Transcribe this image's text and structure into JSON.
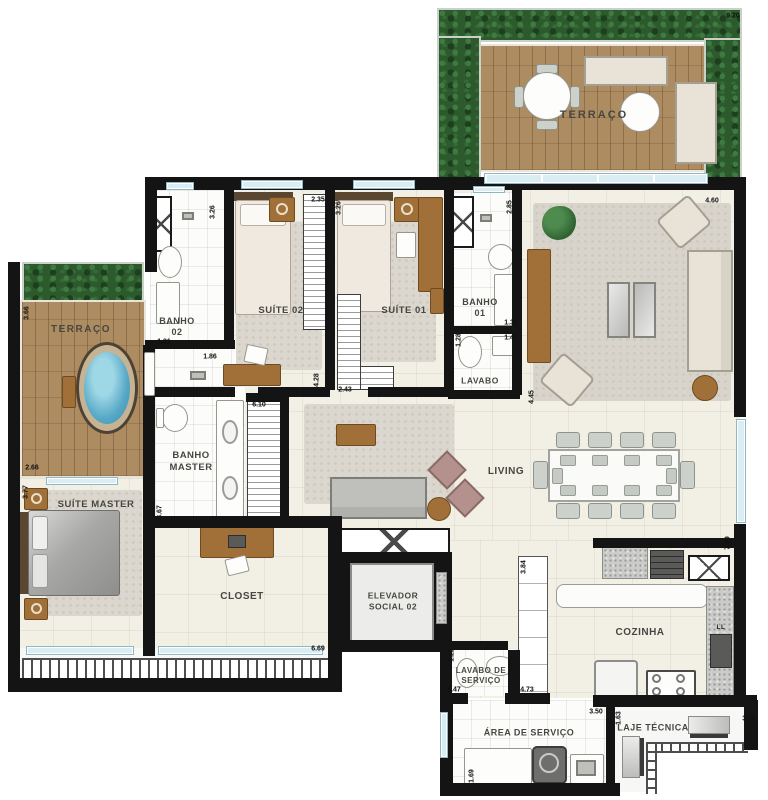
{
  "rooms": {
    "terraco_top": "TERRAÇO",
    "terraco_left": "TERRAÇO",
    "banho02": "BANHO\n02",
    "suite02": "SUÍTE 02",
    "suite01": "SUÍTE 01",
    "banho01": "BANHO\n01",
    "lavabo": "LAVABO",
    "banho_master": "BANHO\nMASTER",
    "suite_master": "SUÍTE MASTER",
    "living": "LIVING",
    "closet": "CLOSET",
    "elevador": "ELEVADOR\nSOCIAL 02",
    "cozinha": "COZINHA",
    "ll": "LL",
    "lavabo_servico": "LAVABO DE\nSERVIÇO",
    "area_servico": "ÁREA DE SERVIÇO",
    "laje_tecnica": "LAJE TÉCNICA"
  },
  "dimensions": {
    "terraco_top_w": "9.20",
    "terraco_left_h": "3.66",
    "terraco_left_w": "2.66",
    "suite_master_h": "3.77",
    "banho02_h": "3.26",
    "suite02_w": "2.35",
    "suite01_h": "3.26",
    "banho02_w": "1.31",
    "hall_banho02_w": "1.86",
    "suite01_door_h": "4.28",
    "suite01_w": "2.43",
    "banho01_h": "2.85",
    "banho01_w": "1.38",
    "lavabo_h": "1.28",
    "lavabo_w": "1.41",
    "living_w": "4.60",
    "living_h": "4.45",
    "living_right_h": "7.69",
    "banho_master_h": "3.67",
    "banho_master_w": "6.10",
    "balcony_w": "6.69",
    "corridor_h": "3.84",
    "lavabo_servico_h": "1.22",
    "lavabo_servico_w": "1.47",
    "corridor_w": "4.73",
    "area_servico_w": "3.50",
    "laje_h": "1.63",
    "laje_w": "3.36",
    "area_servico_h": "1.69"
  },
  "colors": {
    "wall": "#141414",
    "floor": "#f2efe5",
    "deck_wood": "#ad8c62",
    "hedge_green": "#2c5a2d",
    "jacuzzi_water": "#58a9c7",
    "furniture_wood": "#a07038"
  }
}
